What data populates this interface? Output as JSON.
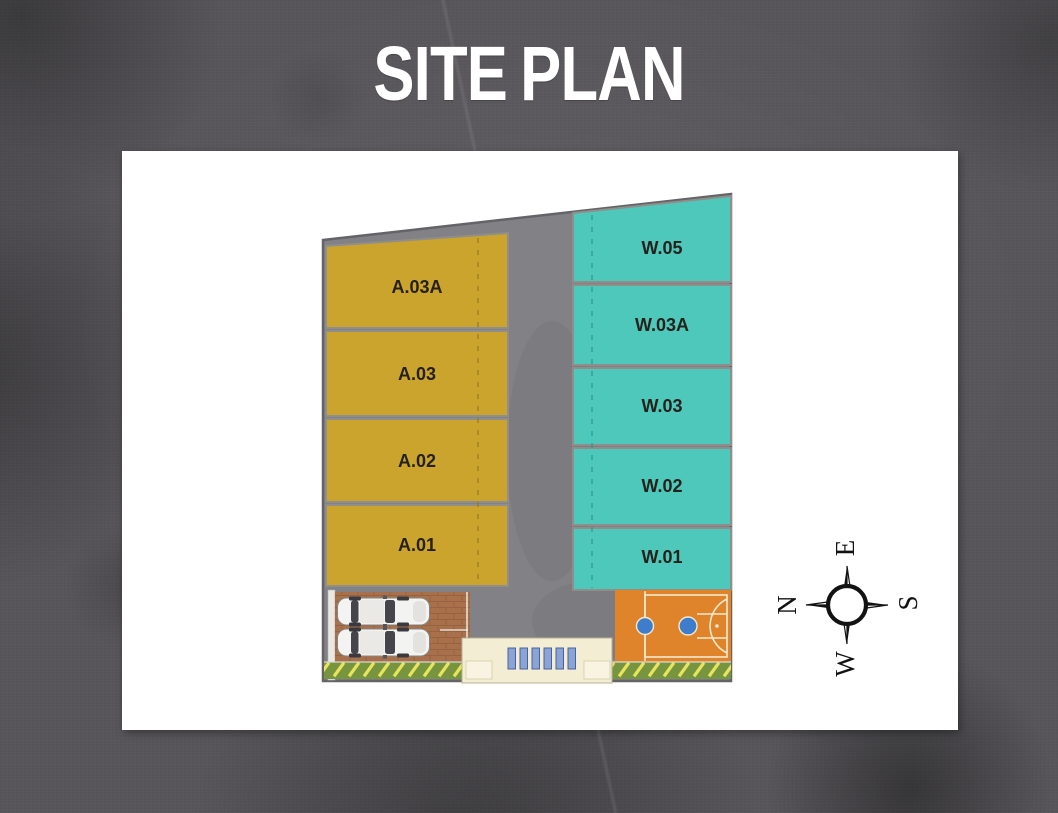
{
  "title": "SITE PLAN",
  "plan": {
    "left_blocks": [
      {
        "label": "A.03A"
      },
      {
        "label": "A.03"
      },
      {
        "label": "A.02"
      },
      {
        "label": "A.01"
      }
    ],
    "right_blocks": [
      {
        "label": "W.05"
      },
      {
        "label": "W.03A"
      },
      {
        "label": "W.03"
      },
      {
        "label": "W.02"
      },
      {
        "label": "W.01"
      }
    ],
    "compass": {
      "north": "N",
      "east": "E",
      "south": "S",
      "west": "W"
    },
    "colors": {
      "background": "#575559",
      "card": "#ffffff",
      "title_text": "#ffffff",
      "gold": "#cba42e",
      "teal": "#4fc8bc",
      "road": "#828186",
      "block_border": "#8f8e8b",
      "label_text": "#26211b",
      "court_orange": "#e0842b",
      "court_line": "#f2e9ce",
      "court_blue": "#3e7ccc",
      "grass_green": "#77953e",
      "hatch_yellow": "#e9e45e",
      "entrance_cream": "#f3eed3",
      "gate_blue": "#8aa4d6",
      "brick": "#a8714c",
      "car_white": "#f3f3f1",
      "compass_ink": "#121212"
    }
  }
}
